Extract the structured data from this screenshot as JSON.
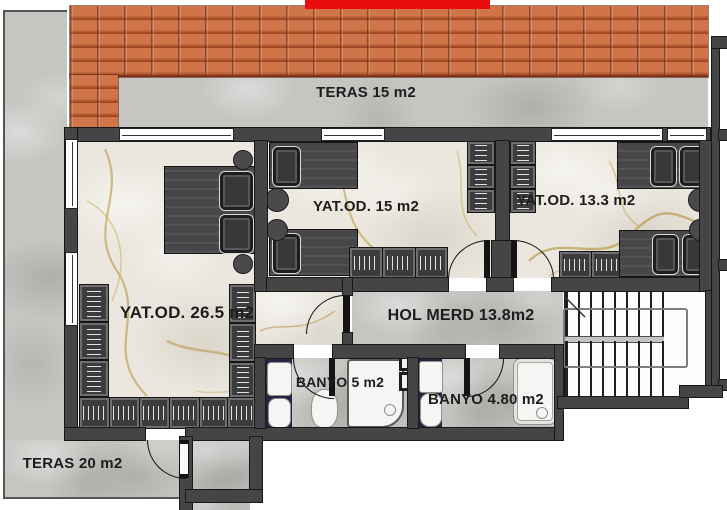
{
  "plan_type": "floor-plan",
  "rooms": [
    {
      "name": "teras-15",
      "label": "TERAS 15 m2"
    },
    {
      "name": "yatak-odasi-26-5",
      "label": "YAT.OD. 26.5 m2"
    },
    {
      "name": "yatak-odasi-15",
      "label": "YAT.OD. 15 m2"
    },
    {
      "name": "yatak-odasi-13-3",
      "label": "YAT.OD. 13.3 m2"
    },
    {
      "name": "hol-merdiven",
      "label": "HOL MERD 13.8m2"
    },
    {
      "name": "banyo-5",
      "label": "BANYO 5 m2"
    },
    {
      "name": "banyo-4-80",
      "label": "BANYO 4.80 m2"
    },
    {
      "name": "teras-20",
      "label": "TERAS 20 m2"
    }
  ],
  "colors": {
    "highlight_red": "#ea0b0e",
    "roof_tile": "#c96f45",
    "wall_gray": "#454545",
    "floor_concrete": "#c7c5c2",
    "floor_marble": "#ebe7de",
    "bathroom_tile_navy": "#232741",
    "marble_vein_gold": "#b39034",
    "furniture_dark": "#3c3c3e"
  }
}
